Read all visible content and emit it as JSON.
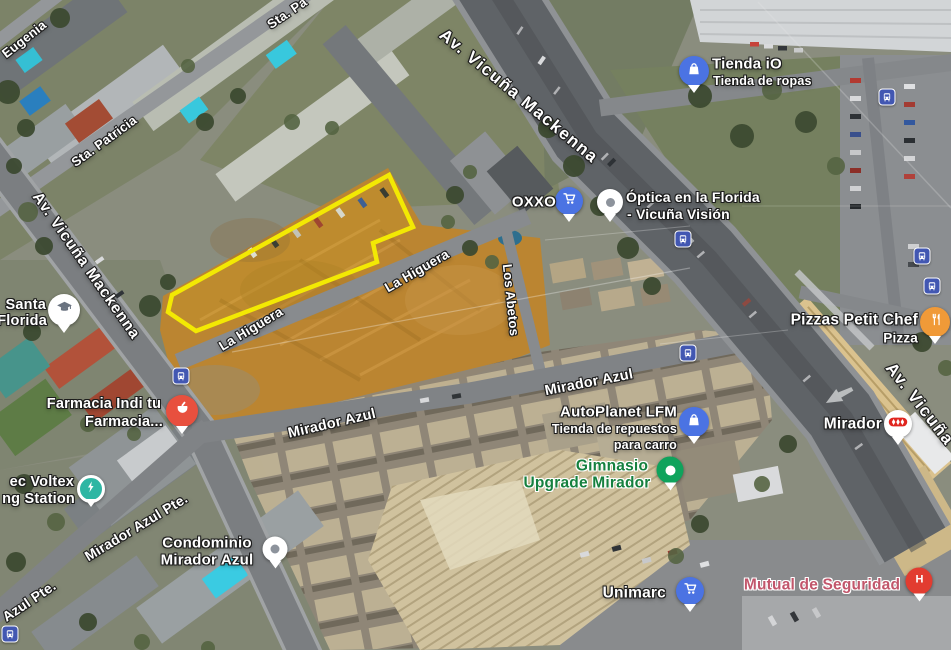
{
  "map": {
    "view": "satellite",
    "streets": {
      "eugenia": "Eugenia",
      "sta_pa": "Sta. Pa",
      "sta_patricia": "Sta. Patricia",
      "av_vicuna_mackenna_left": "Av. Vicuña Mackenna",
      "av_vicuna_mackenna_top": "Av. Vicuña Mackenna",
      "av_vicuna_right": "Av. Vicuña",
      "la_higuera_lower": "La Higuera",
      "la_higuera_upper": "La Higuera",
      "los_abetos": "Los Abetos",
      "mirador_azul_west": "Mirador Azul",
      "mirador_azul_east": "Mirador Azul",
      "mirador_azul_pte": "Mirador Azul Pte.",
      "azul_pte": "Azul Pte."
    },
    "places": {
      "tienda_io": {
        "title": "Tienda iO",
        "subtitle": "Tienda de ropas"
      },
      "oxxo": {
        "title": "OXXO"
      },
      "optica": {
        "line1": "Óptica en la Florida",
        "line2": "- Vicuña Visión"
      },
      "pizzas_petit_chef": {
        "title": "Pizzas Petit Chef",
        "subtitle": "Pizza"
      },
      "santa_florida": {
        "line1": "Santa",
        "line2": "Florida"
      },
      "farmacia": {
        "line1": "Farmacia Indi tu",
        "line2": "Farmacia..."
      },
      "voltex_station": {
        "line1": "ec Voltex",
        "line2": "ng Station"
      },
      "autoplanet": {
        "title": "AutoPlanet LFM",
        "line2": "Tienda de repuestos",
        "line3": "para carro"
      },
      "gimnasio": {
        "line1": "Gimnasio",
        "line2": "Upgrade Mirador"
      },
      "metro_mirador": {
        "title": "Mirador"
      },
      "condominio": {
        "line1": "Condominio",
        "line2": "Mirador Azul"
      },
      "unimarc": {
        "title": "Unimarc"
      },
      "mutual_de_seguridad": {
        "title": "Mutual de Seguridad"
      }
    },
    "colors": {
      "parcel_outline": "#f3e903",
      "pin_blue": "#4b73e3",
      "pin_orange": "#f09a38",
      "pin_pharmacy_red": "#e8503e",
      "pin_hospital_red": "#e23c30",
      "pin_green": "#0fa35c",
      "pin_teal": "#2db6a3",
      "bus_icon_blue": "#4257b2",
      "gym_label_green": "#15803e",
      "hospital_label_pink": "#c2566b",
      "metro_logo_red": "#e0251f"
    }
  }
}
